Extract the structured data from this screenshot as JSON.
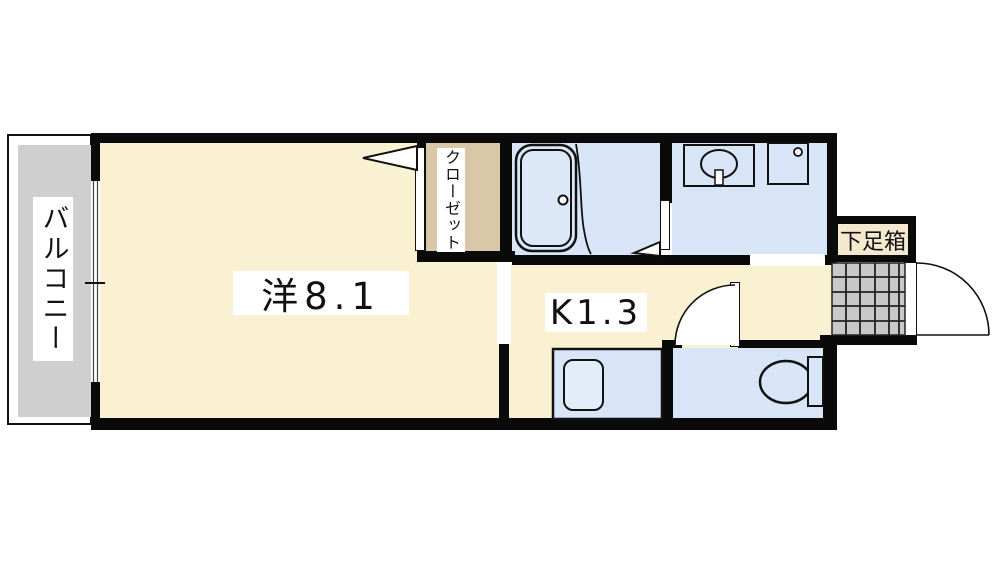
{
  "page": {
    "type": "apartment floor plan (1K)",
    "background": "#ffffff"
  },
  "labels": {
    "balcony": "バルコニー",
    "main_room": "洋8.1",
    "closet": "クローゼット",
    "kitchen": "K1.3",
    "shoe_box": "下足箱"
  },
  "colors": {
    "floor_cream": "#faf0d2",
    "wet_area_blue": "#d8e5f6",
    "closet_tan": "#d8c8a8",
    "balcony_gray": "#cfcfcf",
    "entrance_tile_gray": "#c8c8c8",
    "wall_black": "#0a0a0a",
    "label_background": "#ffffff"
  },
  "fixtures": [
    "bathtub-icon",
    "bath-drain-icon",
    "washbasin-icon",
    "faucet-icon",
    "washing-machine-pan-icon",
    "kitchen-sink-icon",
    "toilet-icon",
    "entrance-door-arc",
    "toilet-door-arc",
    "closet-door-wedge",
    "bathroom-door-wedge",
    "sliding-window",
    "entrance-tile-grid"
  ]
}
